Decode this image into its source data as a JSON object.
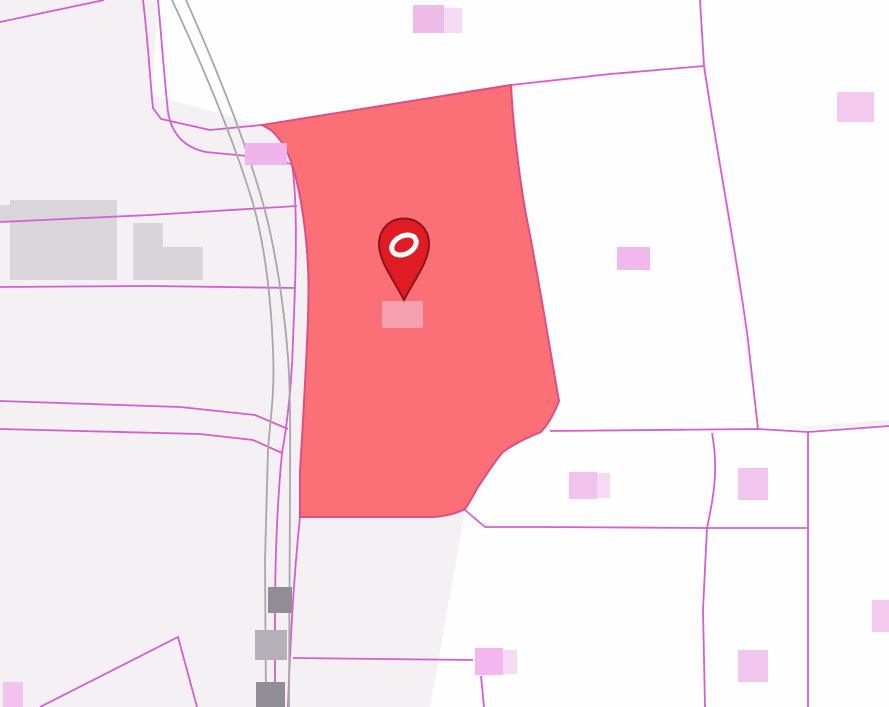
{
  "map": {
    "width": 889,
    "height": 707,
    "colors": {
      "background": "#f4f0f3",
      "parcel_white": "#fefefe",
      "parcel_line": "#d45fd0",
      "road_line": "#a9a6ac",
      "selected_fill": "#fb6a73",
      "selected_stroke": "#db4f86",
      "marker_fill": "#df1c23",
      "marker_stroke": "#901318",
      "marker_ring": "#ffffff"
    },
    "white_parcels": [
      {
        "name": "parcel-north",
        "points": "262,125 511,85 704,66 700,0 158,0 152,95"
      },
      {
        "name": "parcel-northeast",
        "points": "700,0 889,0 889,420 760,430 706,65"
      },
      {
        "name": "parcel-east-of-selected",
        "points": "513,88 704,66 758,429 552,430 522,190"
      },
      {
        "name": "parcel-southeast",
        "points": "550,431 889,427 889,707 430,707 465,510 503,452 540,433"
      }
    ],
    "boundaries": [
      {
        "name": "boundary-topleft-corner",
        "d": "M104,0 L0,22"
      },
      {
        "name": "boundary-top-1",
        "d": "M143,0 C148,40 150,80 153,108 L161,119 L210,130 L262,125"
      },
      {
        "name": "boundary-top-2",
        "d": "M158,0 C162,45 165,85 168,112 C172,136 186,148 206,152 L247,156 L292,164"
      },
      {
        "name": "boundary-west-upper",
        "d": "M0,222 L150,215 L297,206"
      },
      {
        "name": "boundary-west-mid",
        "d": "M0,287 L150,286 L295,288"
      },
      {
        "name": "boundary-west-lower-1",
        "d": "M0,401 L180,407 L255,415 L288,429"
      },
      {
        "name": "boundary-west-lower-2",
        "d": "M0,429 L200,434 L253,440 L282,453"
      },
      {
        "name": "boundary-roadside-upper",
        "d": "M292,164 C298,205 296,270 293,340 C292,382 287,426 282,453"
      },
      {
        "name": "boundary-roadside-lower-left",
        "d": "M282,453 C277,505 275,560 275,620 L275,707"
      },
      {
        "name": "boundary-roadside-lower-right",
        "d": "M300,517 C294,575 290,645 288,707"
      },
      {
        "name": "boundary-northeast-diagonal",
        "d": "M511,85 L610,74 L704,66"
      },
      {
        "name": "boundary-east-vertical",
        "d": "M700,0 L704,66 C718,160 736,250 748,340 L758,429"
      },
      {
        "name": "boundary-east-horizontal",
        "d": "M550,431 L758,429 L808,432 L889,426"
      },
      {
        "name": "boundary-south-horizontal",
        "d": "M465,510 L485,527 L546,527 L705,528 L808,528"
      },
      {
        "name": "boundary-southeast-vertical-1",
        "d": "M808,432 L808,707"
      },
      {
        "name": "boundary-southeast-vertical-2",
        "d": "M712,433 C719,470 713,500 707,528 L703,610 L705,707"
      },
      {
        "name": "boundary-south-spur",
        "d": "M293,658 L473,660"
      },
      {
        "name": "boundary-south-spur-vertical",
        "d": "M481,676 L484,707"
      },
      {
        "name": "boundary-southwest-wedge",
        "d": "M40,707 L178,637 L197,707"
      }
    ],
    "roads": [
      {
        "name": "road-edge-west",
        "d": "M172,0 C200,60 231,132 252,200 C265,245 271,300 273,350 C275,395 270,420 268,450 L265,560 L266,707"
      },
      {
        "name": "road-edge-east",
        "d": "M186,0 C215,65 246,142 264,207 C276,252 284,307 288,357 C291,402 290,445 290,485 L289,707"
      }
    ],
    "buildings_under": [
      {
        "name": "building-industrial-large",
        "x": 10,
        "y": 200,
        "w": 107,
        "h": 80,
        "fill": "#d9d5da"
      },
      {
        "name": "building-industrial-strip",
        "x": 0,
        "y": 205,
        "w": 10,
        "h": 17,
        "fill": "#d9d5da"
      },
      {
        "name": "building-industrial-mid",
        "x": 133,
        "y": 223,
        "w": 30,
        "h": 57,
        "fill": "#d8d4d9"
      },
      {
        "name": "building-industrial-annex",
        "x": 163,
        "y": 247,
        "w": 40,
        "h": 33,
        "fill": "#d8d4d9"
      }
    ],
    "buildings_over": [
      {
        "name": "building-roadside-upper",
        "x": 268,
        "y": 587,
        "w": 24,
        "h": 26,
        "fill": "#918d95"
      },
      {
        "name": "building-roadside-mid",
        "x": 255,
        "y": 630,
        "w": 32,
        "h": 30,
        "fill": "#b5b0b8"
      },
      {
        "name": "building-roadside-lower",
        "x": 256,
        "y": 682,
        "w": 29,
        "h": 25,
        "fill": "#918d95"
      },
      {
        "name": "building-north",
        "x": 413,
        "y": 5,
        "w": 31,
        "h": 28,
        "fill": "#eebbe9"
      },
      {
        "name": "building-north-annex",
        "x": 444,
        "y": 8,
        "w": 18,
        "h": 25,
        "fill": "#f6d9f3"
      },
      {
        "name": "building-northwest-of-parcel",
        "x": 245,
        "y": 143,
        "w": 42,
        "h": 22,
        "fill": "#f0b4ec"
      },
      {
        "name": "building-northeast",
        "x": 837,
        "y": 92,
        "w": 37,
        "h": 30,
        "fill": "#f3c9ef"
      },
      {
        "name": "building-east",
        "x": 617,
        "y": 247,
        "w": 33,
        "h": 23,
        "fill": "#f0b8ec"
      },
      {
        "name": "building-southeast-1",
        "x": 569,
        "y": 472,
        "w": 28,
        "h": 27,
        "fill": "#f1c2ed"
      },
      {
        "name": "building-southeast-1-annex",
        "x": 597,
        "y": 473,
        "w": 13,
        "h": 25,
        "fill": "#f6d9f3"
      },
      {
        "name": "building-southeast-2",
        "x": 738,
        "y": 468,
        "w": 30,
        "h": 32,
        "fill": "#f1c6ee"
      },
      {
        "name": "building-southeast-3",
        "x": 738,
        "y": 650,
        "w": 30,
        "h": 32,
        "fill": "#f1c6ee"
      },
      {
        "name": "building-south",
        "x": 475,
        "y": 648,
        "w": 28,
        "h": 27,
        "fill": "#f5b5ef"
      },
      {
        "name": "building-south-annex",
        "x": 503,
        "y": 650,
        "w": 14,
        "h": 24,
        "fill": "#f6d9f3"
      },
      {
        "name": "building-southwest",
        "x": 3,
        "y": 682,
        "w": 20,
        "h": 25,
        "fill": "#f3c3ef"
      },
      {
        "name": "building-right-edge",
        "x": 872,
        "y": 600,
        "w": 17,
        "h": 32,
        "fill": "#f3c9ef"
      },
      {
        "name": "building-in-selected-parcel",
        "x": 382,
        "y": 301,
        "w": 41,
        "h": 27,
        "fill": "#f69fad"
      }
    ],
    "selected_parcel": {
      "name": "selected-parcel",
      "d": "M262,125 L271,130 C283,141 288,152 292,165 C300,188 306,228 308,266 C310,302 306,362 303,422 L300,472 L300,517 L433,517 C449,516 459,512 465,509 C470,502 474,494 478,487 C488,472 495,461 503,452 C515,443 529,437 541,432 C549,423 555,412 559,401 C550,350 538,275 528,225 C521,190 513,130 511,85 Z"
    },
    "marker": {
      "pin_d": "M404 300 C392 277 379 261 379 244 C379 229 390 218.5 404 218.5 C418 218.5 429 229 429 244 C429 261 416 277 404 300 Z",
      "ring": {
        "cx": 404,
        "cy": 245,
        "rx": 13,
        "ry": 9,
        "rotate": -28,
        "width": 5
      }
    }
  }
}
